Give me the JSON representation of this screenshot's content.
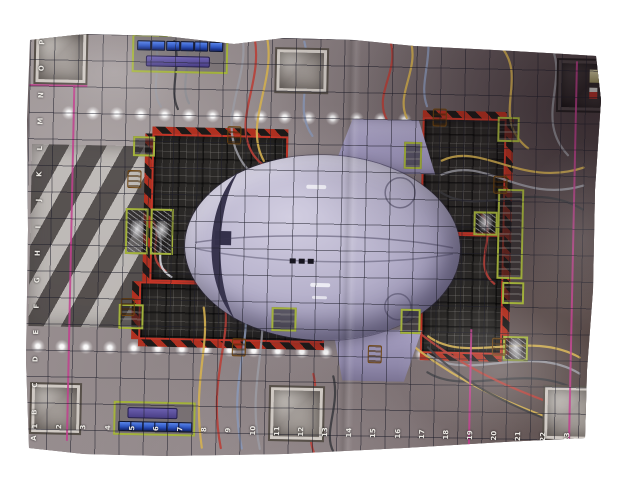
{
  "scene": {
    "description": "photograph of a sci-fi crash-site game mat with coordinate grid, crashed saucer ship, landing-pad gratings and cable runs",
    "background_color": "#ffffff"
  },
  "mat": {
    "grid": {
      "row_letters_top_to_bottom": [
        "P",
        "O",
        "N",
        "M",
        "L",
        "K",
        "J",
        "I",
        "H",
        "G",
        "F",
        "E",
        "D",
        "C",
        "B",
        "A"
      ],
      "col_numbers": [
        "1",
        "2",
        "3",
        "4",
        "5",
        "6",
        "7",
        "8",
        "9",
        "10",
        "11",
        "12",
        "13",
        "14",
        "15",
        "16",
        "17",
        "18",
        "19",
        "20",
        "21",
        "22",
        "23",
        "24"
      ]
    },
    "consoles": {
      "screens_per_console": 6
    },
    "palette": {
      "floor": "#8d8385",
      "ship_hull": "#b7b2cc",
      "zone_border_red": "#c33527",
      "equipment_box_green": "#a3b23c",
      "console_screen_blue": "#2e55c0",
      "console_body_purple": "#4a3f86",
      "boundary_pink": "#c23f8e",
      "clamp_orange": "#d88f2b",
      "hazard_red": "#b03020",
      "hazard_black": "#1d1a18"
    }
  }
}
